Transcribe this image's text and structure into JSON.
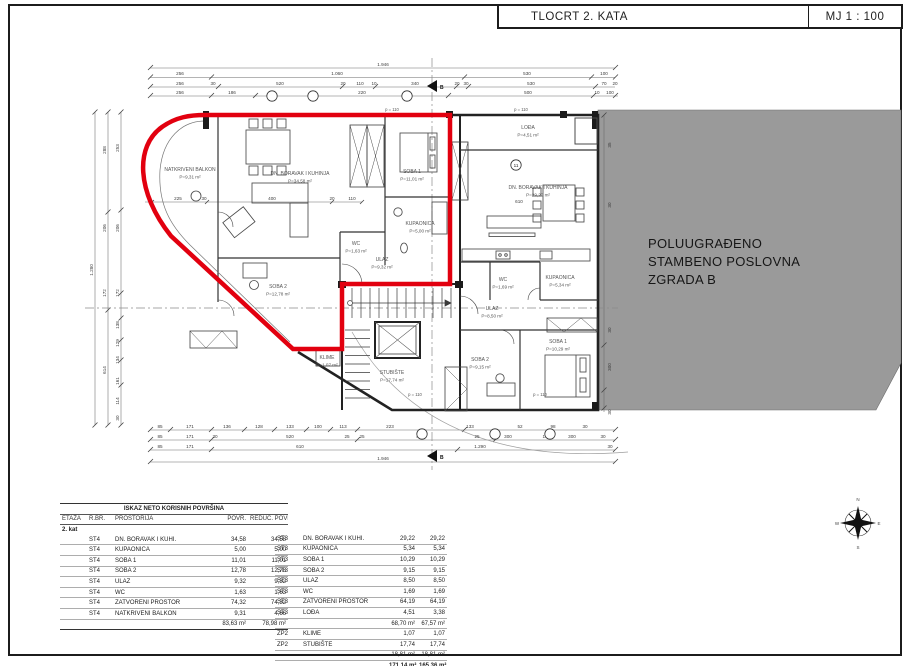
{
  "title_block": {
    "title": "TLOCRT 2. KATA",
    "scale": "MJ 1 : 100"
  },
  "colors": {
    "apartment_outline": "#e2000f",
    "building_b_fill": "#9a9a9a",
    "wall": "#222222"
  },
  "building_b": {
    "lines": [
      "POLUUGRAĐENO",
      "STAMBENO POSLOVNA",
      "ZGRADA B"
    ]
  },
  "plan": {
    "section_marker": "B",
    "rooms": [
      {
        "n": "NATKRIVENI BALKON",
        "a": "P=9,31 m²",
        "x": 190,
        "y": 171
      },
      {
        "n": "DN. BORAVAK I KUHINJA",
        "a": "P=34,58 m²",
        "x": 300,
        "y": 175
      },
      {
        "n": "SOBA 1",
        "a": "P=11,01 m²",
        "x": 412,
        "y": 173
      },
      {
        "n": "KUPAONICA",
        "a": "P=5,00 m²",
        "x": 420,
        "y": 225
      },
      {
        "n": "WC",
        "a": "P=1,63 m²",
        "x": 356,
        "y": 245
      },
      {
        "n": "ULAZ",
        "a": "P=9,32 m²",
        "x": 382,
        "y": 261
      },
      {
        "n": "SOBA 2",
        "a": "P=12,78 m²",
        "x": 278,
        "y": 288
      },
      {
        "n": "KLIME",
        "a": "P=1,07 m²",
        "x": 327,
        "y": 359
      },
      {
        "n": "STUBIŠTE",
        "a": "P=17,74 m²",
        "x": 392,
        "y": 374
      },
      {
        "n": "LOĐA",
        "a": "P=4,51 m²",
        "x": 528,
        "y": 129
      },
      {
        "n": "DN. BORAVAK I KUHINJA",
        "a": "P=29,22 m²",
        "x": 538,
        "y": 189
      },
      {
        "n": "KUPAONICA",
        "a": "P=5,34 m²",
        "x": 560,
        "y": 279
      },
      {
        "n": "WC",
        "a": "P=1,69 m²",
        "x": 503,
        "y": 281
      },
      {
        "n": "ULAZ",
        "a": "P=8,50 m²",
        "x": 492,
        "y": 310
      },
      {
        "n": "SOBA 2",
        "a": "P=9,15 m²",
        "x": 480,
        "y": 361
      },
      {
        "n": "SOBA 1",
        "a": "P=10,29 m²",
        "x": 558,
        "y": 343
      }
    ],
    "parapets": [
      {
        "t": "p = 110",
        "x": 392,
        "y": 111
      },
      {
        "t": "p = 110",
        "x": 521,
        "y": 111
      },
      {
        "t": "p = 110",
        "x": 415,
        "y": 396
      },
      {
        "t": "p = 110",
        "x": 540,
        "y": 396
      }
    ],
    "dims": [
      {
        "t": "1.946",
        "x": 383,
        "y": 66
      },
      {
        "t": "256",
        "x": 180,
        "y": 75
      },
      {
        "t": "1.060",
        "x": 337,
        "y": 75
      },
      {
        "t": "530",
        "x": 527,
        "y": 75
      },
      {
        "t": "100",
        "x": 604,
        "y": 75
      },
      {
        "t": "256",
        "x": 180,
        "y": 85
      },
      {
        "t": "30",
        "x": 213,
        "y": 85
      },
      {
        "t": "520",
        "x": 280,
        "y": 85
      },
      {
        "t": "20",
        "x": 343,
        "y": 85
      },
      {
        "t": "110",
        "x": 360,
        "y": 85
      },
      {
        "t": "10",
        "x": 374,
        "y": 85
      },
      {
        "t": "340",
        "x": 415,
        "y": 85
      },
      {
        "t": "20",
        "x": 457,
        "y": 85
      },
      {
        "t": "30",
        "x": 466,
        "y": 85
      },
      {
        "t": "530",
        "x": 531,
        "y": 85
      },
      {
        "t": "70",
        "x": 604,
        "y": 85
      },
      {
        "t": "20",
        "x": 615,
        "y": 85
      },
      {
        "t": "256",
        "x": 180,
        "y": 94
      },
      {
        "t": "186",
        "x": 232,
        "y": 94
      },
      {
        "t": "220",
        "x": 362,
        "y": 94
      },
      {
        "t": "500",
        "x": 528,
        "y": 94
      },
      {
        "t": "10",
        "x": 597,
        "y": 94
      },
      {
        "t": "100",
        "x": 610,
        "y": 94
      },
      {
        "t": "225",
        "x": 178,
        "y": 200
      },
      {
        "t": "30",
        "x": 204,
        "y": 200
      },
      {
        "t": "400",
        "x": 272,
        "y": 200
      },
      {
        "t": "20",
        "x": 332,
        "y": 200
      },
      {
        "t": "110",
        "x": 352,
        "y": 200
      },
      {
        "t": "610",
        "x": 519,
        "y": 203
      },
      {
        "t": "85",
        "x": 160,
        "y": 428
      },
      {
        "t": "171",
        "x": 190,
        "y": 428
      },
      {
        "t": "136",
        "x": 227,
        "y": 428
      },
      {
        "t": "128",
        "x": 259,
        "y": 428
      },
      {
        "t": "133",
        "x": 290,
        "y": 428
      },
      {
        "t": "100",
        "x": 318,
        "y": 428
      },
      {
        "t": "113",
        "x": 343,
        "y": 428
      },
      {
        "t": "223",
        "x": 390,
        "y": 428
      },
      {
        "t": "133",
        "x": 470,
        "y": 428
      },
      {
        "t": "52",
        "x": 520,
        "y": 428
      },
      {
        "t": "98",
        "x": 553,
        "y": 428
      },
      {
        "t": "30",
        "x": 585,
        "y": 428
      },
      {
        "t": "85",
        "x": 160,
        "y": 438
      },
      {
        "t": "171",
        "x": 190,
        "y": 438
      },
      {
        "t": "30",
        "x": 215,
        "y": 438
      },
      {
        "t": "520",
        "x": 290,
        "y": 438
      },
      {
        "t": "25",
        "x": 347,
        "y": 438
      },
      {
        "t": "25",
        "x": 362,
        "y": 438
      },
      {
        "t": "415",
        "x": 420,
        "y": 438
      },
      {
        "t": "25",
        "x": 477,
        "y": 438
      },
      {
        "t": "300",
        "x": 508,
        "y": 438
      },
      {
        "t": "10",
        "x": 545,
        "y": 438
      },
      {
        "t": "300",
        "x": 572,
        "y": 438
      },
      {
        "t": "30",
        "x": 603,
        "y": 438
      },
      {
        "t": "85",
        "x": 160,
        "y": 448
      },
      {
        "t": "171",
        "x": 190,
        "y": 448
      },
      {
        "t": "610",
        "x": 300,
        "y": 448
      },
      {
        "t": "1.290",
        "x": 480,
        "y": 448
      },
      {
        "t": "30",
        "x": 610,
        "y": 448
      },
      {
        "t": "1.946",
        "x": 383,
        "y": 460
      },
      {
        "t": "1.280",
        "x": 93,
        "y": 270,
        "r": -90
      },
      {
        "t": "288",
        "x": 106,
        "y": 150,
        "r": -90
      },
      {
        "t": "206",
        "x": 106,
        "y": 228,
        "r": -90
      },
      {
        "t": "172",
        "x": 106,
        "y": 293,
        "r": -90
      },
      {
        "t": "614",
        "x": 106,
        "y": 370,
        "r": -90
      },
      {
        "t": "253",
        "x": 119,
        "y": 148,
        "r": -90
      },
      {
        "t": "206",
        "x": 119,
        "y": 228,
        "r": -90
      },
      {
        "t": "172",
        "x": 119,
        "y": 293,
        "r": -90
      },
      {
        "t": "138",
        "x": 119,
        "y": 325,
        "r": -90
      },
      {
        "t": "129",
        "x": 119,
        "y": 343,
        "r": -90
      },
      {
        "t": "134",
        "x": 119,
        "y": 360,
        "r": -90
      },
      {
        "t": "161",
        "x": 119,
        "y": 381,
        "r": -90
      },
      {
        "t": "114",
        "x": 119,
        "y": 401,
        "r": -90
      },
      {
        "t": "30",
        "x": 119,
        "y": 418,
        "r": -90
      },
      {
        "t": "35",
        "x": 611,
        "y": 145,
        "r": -90
      },
      {
        "t": "30",
        "x": 611,
        "y": 205,
        "r": -90
      },
      {
        "t": "30",
        "x": 611,
        "y": 330,
        "r": -90
      },
      {
        "t": "300",
        "x": 611,
        "y": 367,
        "r": -90
      },
      {
        "t": "30",
        "x": 611,
        "y": 412,
        "r": -90
      }
    ],
    "axis_bubbles": [
      {
        "n": "",
        "x": 272,
        "y": 96
      },
      {
        "n": "",
        "x": 313,
        "y": 96
      },
      {
        "n": "",
        "x": 407,
        "y": 96
      },
      {
        "n": "11",
        "x": 516,
        "y": 165
      },
      {
        "n": "",
        "x": 422,
        "y": 434
      },
      {
        "n": "",
        "x": 495,
        "y": 434
      },
      {
        "n": "",
        "x": 550,
        "y": 434
      }
    ],
    "compass_letters": [
      "N",
      "E",
      "S",
      "W"
    ]
  },
  "area_table": {
    "title": "ISKAZ NETO KORISNIH POVRŠINA",
    "headers": [
      "ETAŽA",
      "R.BR.",
      "PROSTORIJA",
      "POVR.",
      "REDUC. POVRŠINA"
    ],
    "floor_label": "2. kat",
    "left_rows": [
      [
        "ST4",
        "DN. BORAVAK I KUHI.",
        "34,58",
        "34,58"
      ],
      [
        "ST4",
        "KUPAONICA",
        "5,00",
        "5,00"
      ],
      [
        "ST4",
        "SOBA 1",
        "11,01",
        "11,01"
      ],
      [
        "ST4",
        "SOBA 2",
        "12,78",
        "12,78"
      ],
      [
        "ST4",
        "ULAZ",
        "9,32",
        "9,32"
      ],
      [
        "ST4",
        "WC",
        "1,63",
        "1,63"
      ],
      [
        "ST4",
        "ZATVORENI PROSTOR",
        "74,32",
        "74,32"
      ],
      [
        "ST4",
        "NATKRIVENI BALKON",
        "9,31",
        "4,66"
      ]
    ],
    "left_total": [
      "83,63 m²",
      "78,98 m²"
    ],
    "right_rows": [
      [
        "ST3",
        "DN. BORAVAK I KUHI.",
        "29,22",
        "29,22"
      ],
      [
        "ST3",
        "KUPAONICA",
        "5,34",
        "5,34"
      ],
      [
        "ST3",
        "SOBA 1",
        "10,29",
        "10,29"
      ],
      [
        "ST3",
        "SOBA 2",
        "9,15",
        "9,15"
      ],
      [
        "ST3",
        "ULAZ",
        "8,50",
        "8,50"
      ],
      [
        "ST3",
        "WC",
        "1,69",
        "1,69"
      ],
      [
        "ST3",
        "ZATVORENI PROSTOR",
        "64,19",
        "64,19"
      ],
      [
        "ST3",
        "LOĐA",
        "4,51",
        "3,38"
      ]
    ],
    "right_subtotal": [
      "68,70 m²",
      "67,57 m²"
    ],
    "zp_rows": [
      [
        "ZP2",
        "KLIME",
        "1,07",
        "1,07"
      ],
      [
        "ZP2",
        "STUBIŠTE",
        "17,74",
        "17,74"
      ]
    ],
    "zp_subtotal": [
      "18,81 m²",
      "18,81 m²"
    ],
    "grand_total": [
      "171,14 m²",
      "165,36 m²"
    ]
  }
}
